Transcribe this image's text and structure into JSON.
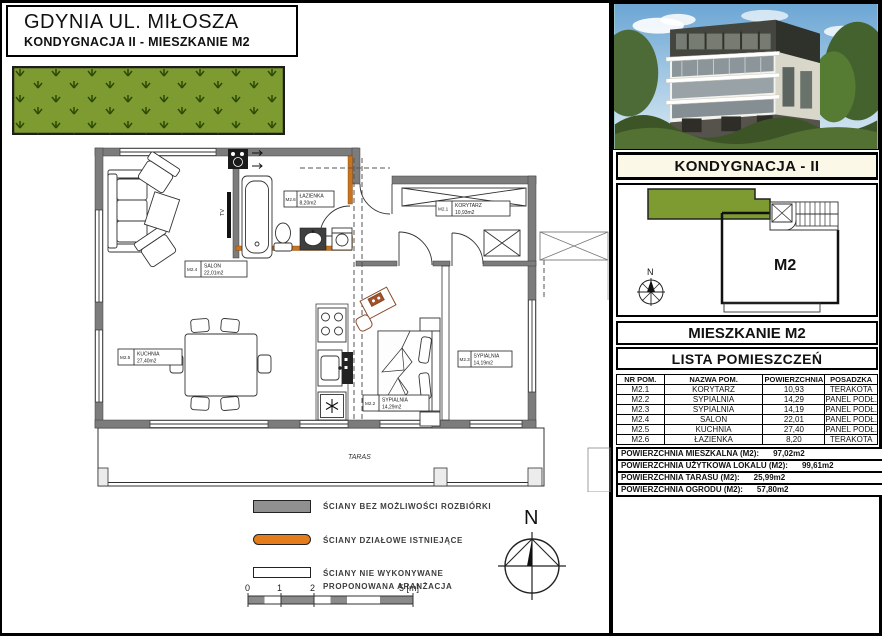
{
  "title_block": {
    "line1": "GDYNIA UL. MIŁOSZA",
    "line2": "KONDYGNACJA II - MIESZKANIE M2"
  },
  "colors": {
    "garden_green": "#7d9b31",
    "wall_gray": "#7c7c7c",
    "partition_orange": "#c8741f",
    "legend_gray": "#909090",
    "legend_orange": "#e47c1c",
    "legend_white": "#ffffff",
    "header_cream": "#fbf8e8"
  },
  "floor_plan": {
    "taras_label": "TARAS",
    "tv_label": "TV",
    "north_label": "N"
  },
  "plan_labels": {
    "korytarz": {
      "id": "M2.1",
      "name": "KORYTARZ",
      "area": "10,93m2"
    },
    "sypialnia_2": {
      "id": "M2.2",
      "name": "SYPIALNIA",
      "area": "14,29m2"
    },
    "sypialnia_3": {
      "id": "M2.3",
      "name": "SYPIALNIA",
      "area": "14,19m2"
    },
    "salon": {
      "id": "M2.4",
      "name": "SALON",
      "area": "22,01m2"
    },
    "kuchnia": {
      "id": "M2.5",
      "name": "KUCHNIA",
      "area": "27,40m2"
    },
    "lazienka": {
      "id": "M2.6",
      "name": "ŁAZIENKA",
      "area": "8,20m2"
    }
  },
  "legend": {
    "items": [
      {
        "label": "ŚCIANY BEZ MOŻLIWOŚCI ROZBIÓRKI"
      },
      {
        "label": "ŚCIANY DZIAŁOWE ISTNIEJĄCE"
      },
      {
        "label": "ŚCIANY NIE WYKONYWANE",
        "label2": "PROPONOWANA ARANŻACJA"
      }
    ]
  },
  "scale_bar": {
    "labels": [
      "0",
      "1",
      "2",
      "5 [m]"
    ]
  },
  "sidebar": {
    "kondygnacja_header": "KONDYGNACJA - II",
    "site_plan": {
      "unit_label": "M2",
      "north_label": "N"
    },
    "mieszkanie_header": "MIESZKANIE M2",
    "lista_header": "LISTA POMIESZCZEŃ",
    "table": {
      "headers": [
        "NR POM.",
        "NAZWA POM.",
        "POWIERZCHNIA",
        "POSADZKA"
      ],
      "rows": [
        [
          "M2.1",
          "KORYTARZ",
          "10,93",
          "TERAKOTA"
        ],
        [
          "M2.2",
          "SYPIALNIA",
          "14,29",
          "PANEL PODŁ."
        ],
        [
          "M2.3",
          "SYPIALNIA",
          "14,19",
          "PANEL PODŁ."
        ],
        [
          "M2.4",
          "SALON",
          "22,01",
          "PANEL PODŁ."
        ],
        [
          "M2.5",
          "KUCHNIA",
          "27,40",
          "PANEL PODŁ."
        ],
        [
          "M2.6",
          "ŁAZIENKA",
          "8,20",
          "TERAKOTA"
        ]
      ]
    },
    "summary": [
      {
        "label": "POWIERZCHNIA MIESZKALNA (M2):",
        "value": "97,02m2"
      },
      {
        "label": "POWIERZCHNIA UŻYTKOWA LOKALU (M2):",
        "value": "99,61m2"
      },
      {
        "label": "POWIERZCHNIA TARASU (M2):",
        "value": "25,99m2"
      },
      {
        "label": "POWIERZCHNIA OGRODU (M2):",
        "value": "57,80m2"
      }
    ]
  }
}
